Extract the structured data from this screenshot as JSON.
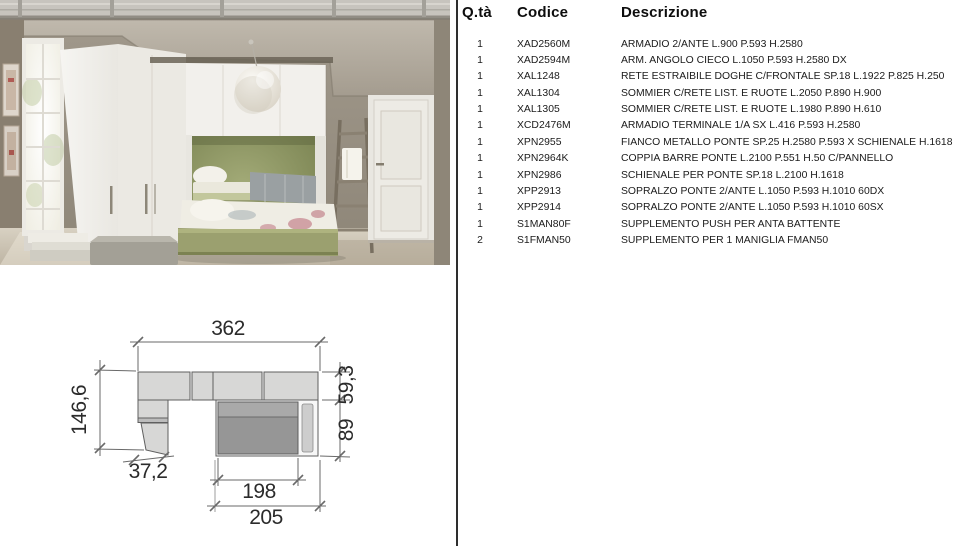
{
  "parts_table": {
    "headers": {
      "qty": "Q.tà",
      "code": "Codice",
      "desc": "Descrizione"
    },
    "rows": [
      {
        "qty": "1",
        "code": "XAD2560M",
        "desc": "ARMADIO 2/ANTE L.900 P.593 H.2580"
      },
      {
        "qty": "1",
        "code": "XAD2594M",
        "desc": "ARM. ANGOLO CIECO L.1050 P.593 H.2580 DX"
      },
      {
        "qty": "1",
        "code": "XAL1248",
        "desc": "RETE ESTRAIBILE DOGHE C/FRONTALE SP.18 L.1922 P.825 H.250"
      },
      {
        "qty": "1",
        "code": "XAL1304",
        "desc": "SOMMIER C/RETE LIST. E RUOTE L.2050 P.890 H.900"
      },
      {
        "qty": "1",
        "code": "XAL1305",
        "desc": "SOMMIER C/RETE LIST. E RUOTE L.1980 P.890 H.610"
      },
      {
        "qty": "1",
        "code": "XCD2476M",
        "desc": "ARMADIO TERMINALE 1/A SX L.416 P.593 H.2580"
      },
      {
        "qty": "1",
        "code": "XPN2955",
        "desc": "FIANCO METALLO PONTE SP.25 H.2580 P.593 X SCHIENALE H.1618"
      },
      {
        "qty": "1",
        "code": "XPN2964K",
        "desc": "COPPIA BARRE PONTE L.2100 P.551 H.50 C/PANNELLO"
      },
      {
        "qty": "1",
        "code": "XPN2986",
        "desc": "SCHIENALE PER PONTE SP.18 L.2100 H.1618"
      },
      {
        "qty": "1",
        "code": "XPP2913",
        "desc": "SOPRALZO PONTE 2/ANTE L.1050 P.593 H.1010 60DX"
      },
      {
        "qty": "1",
        "code": "XPP2914",
        "desc": "SOPRALZO PONTE 2/ANTE L.1050 P.593 H.1010 60SX"
      },
      {
        "qty": "1",
        "code": "S1MAN80F",
        "desc": "SUPPLEMENTO PUSH PER ANTA BATTENTE"
      },
      {
        "qty": "2",
        "code": "S1FMAN50",
        "desc": "SUPPLEMENTO PER 1 MANIGLIA FMAN50"
      }
    ]
  },
  "floor_plan": {
    "dims": {
      "total_width": "362",
      "left_depth": "146,6",
      "corner_width": "37,2",
      "top_depth": "59,3",
      "bed_width": "89",
      "bed_inner_length": "198",
      "bed_outer_length": "205"
    }
  },
  "photo": {
    "description": "Kids bedroom: white corner wardrobe and bridge wardrobe over an olive-green alcove with two stacked pull-out sommier beds, white sphere pendant lamp, wooden ladder against the wall and a white panelled door."
  },
  "colors": {
    "accent_green": "#8b9363",
    "wall_taupe": "#9a9285",
    "plan_fill_light": "#d7d7d6",
    "plan_fill_dark": "#969696",
    "divider": "#2e2e2e"
  }
}
